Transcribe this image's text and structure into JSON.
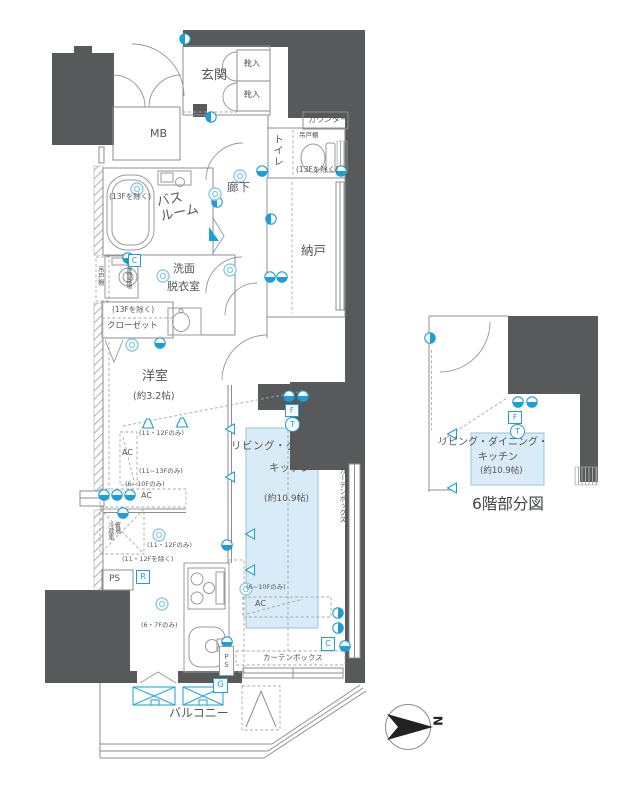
{
  "colors": {
    "wall": "#58595b",
    "accent_blue": "#1c9ed9",
    "room_fill": "#d9ebf7"
  },
  "labels": {
    "genkan": "玄関",
    "shoe": "靴入",
    "mb": "MB",
    "counter": "カウンター",
    "toilet": "トイレ",
    "hanging_cupboard": "吊戸棚",
    "exc_13f": "(13Fを除く)",
    "hallway": "廊下",
    "bath1": "バス",
    "bath2": "ルーム",
    "storage": "納戸",
    "wash1": "洗面",
    "wash2": "脱衣室",
    "laundry": "洗濯機置場",
    "closet": "クローゼット",
    "western": "洋室",
    "western_size": "(約3.2帖)",
    "only_11_12f": "(11・12Fのみ)",
    "only_11_13f": "(11~13Fのみ)",
    "only_6_10f": "(6~10Fのみ)",
    "exc_11_12f": "(11・12Fを除く)",
    "only_6_7f": "(6・7Fのみ)",
    "ac": "AC",
    "ldk1": "リビング・ダイニング・",
    "ldk2": "キッチン",
    "ldk_size": "(約10.9帖)",
    "fridge1": "冷蔵庫",
    "fridge2": "置場",
    "ps": "PS",
    "balcony": "バルコニー",
    "curtain_box": "カーテンボックス",
    "sym_c": "C",
    "sym_r": "R",
    "sym_g": "G",
    "sym_f": "F",
    "sym_t": "T"
  },
  "partial": {
    "title": "6階部分図"
  },
  "compass": {
    "north": "N"
  }
}
